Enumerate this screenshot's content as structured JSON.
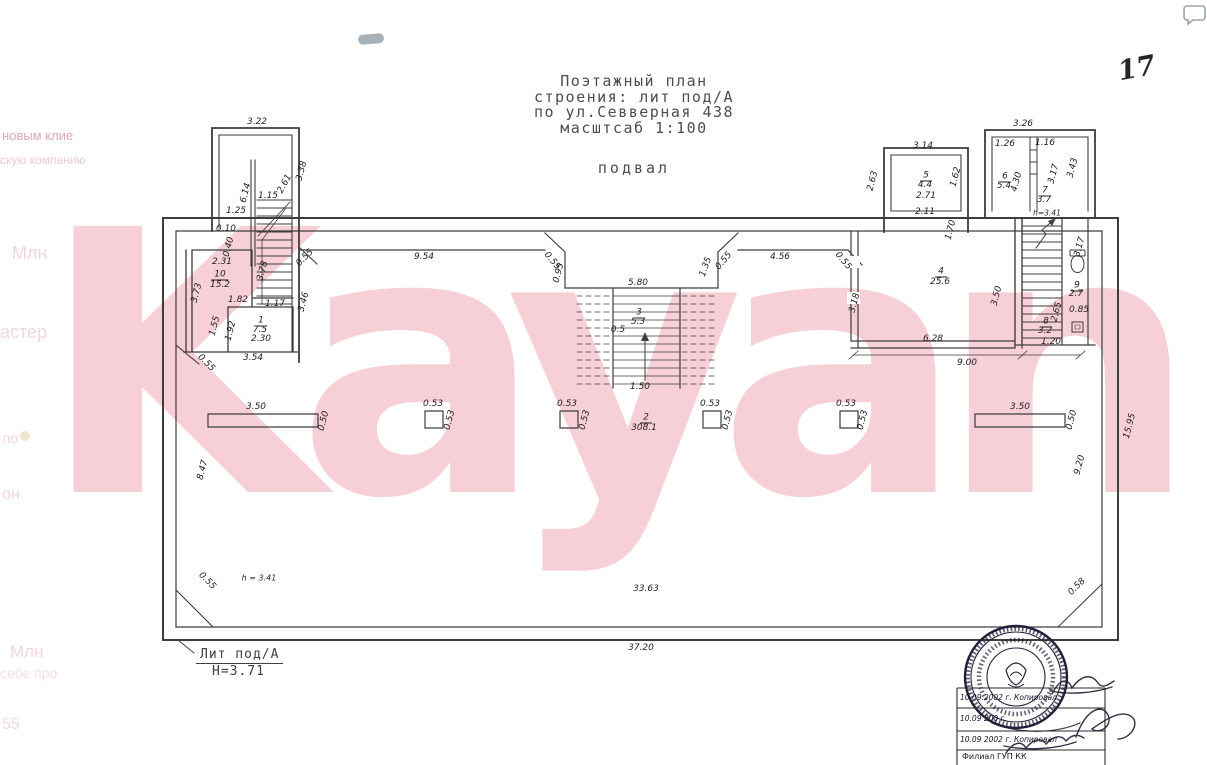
{
  "page": {
    "page_number": "17",
    "watermark_text": "Kayan",
    "watermark_color": "#f7cfd7",
    "line_color": "#3d3d3d",
    "stamp_ink_color": "#20203a"
  },
  "sidebar_fragments": [
    {
      "t": "новым клие",
      "x": 2,
      "y": 128,
      "s": 13,
      "c": "#dfa8b1"
    },
    {
      "t": "скую компанию",
      "x": 0,
      "y": 153,
      "s": 12,
      "c": "#ecc9cf"
    },
    {
      "t": "Млн",
      "x": 12,
      "y": 243,
      "s": 18,
      "c": "#f2d7da"
    },
    {
      "t": "астер",
      "x": 0,
      "y": 322,
      "s": 18,
      "c": "#f2d7da"
    },
    {
      "t": "ло",
      "x": 2,
      "y": 430,
      "s": 14,
      "c": "#f0d4d7"
    },
    {
      "t": "он",
      "x": 2,
      "y": 486,
      "s": 16,
      "c": "#f1d6d9"
    },
    {
      "t": "Млн",
      "x": 10,
      "y": 642,
      "s": 17,
      "c": "#f2d7da"
    },
    {
      "t": "себе про",
      "x": 0,
      "y": 665,
      "s": 14,
      "c": "#f5dfe1"
    },
    {
      "t": "55",
      "x": 2,
      "y": 716,
      "s": 16,
      "c": "#f3dadc"
    }
  ],
  "title_block": {
    "lines": [
      "Поэтажный план",
      "строения: лит под/А",
      "по ул.Севверная 438",
      "масштсаб 1:100"
    ],
    "floor_label": "подвал"
  },
  "plan": {
    "labels": [
      {
        "t": "3.22",
        "x": 257,
        "y": 122
      },
      {
        "t": "3.38",
        "x": 302,
        "y": 171,
        "r": -75
      },
      {
        "t": "6.14",
        "x": 246,
        "y": 193,
        "r": -75
      },
      {
        "t": "1.15",
        "x": 268,
        "y": 196
      },
      {
        "t": "2.61",
        "x": 285,
        "y": 184,
        "r": -62
      },
      {
        "t": "1.25",
        "x": 236,
        "y": 211
      },
      {
        "t": "0.10",
        "x": 226,
        "y": 229
      },
      {
        "t": "0.40",
        "x": 229,
        "y": 247,
        "r": -75
      },
      {
        "t": "2.31",
        "x": 222,
        "y": 262
      },
      {
        "t": "10",
        "x": 220,
        "y": 275,
        "u": 1
      },
      {
        "t": "15.2",
        "x": 220,
        "y": 285
      },
      {
        "t": "3.73",
        "x": 197,
        "y": 293,
        "r": -75
      },
      {
        "t": "1.82",
        "x": 238,
        "y": 300
      },
      {
        "t": "3.78",
        "x": 263,
        "y": 271,
        "r": -75
      },
      {
        "t": "1.17",
        "x": 275,
        "y": 304
      },
      {
        "t": "3.46",
        "x": 304,
        "y": 302,
        "r": -75
      },
      {
        "t": "1.55",
        "x": 215,
        "y": 326,
        "r": -75
      },
      {
        "t": "1",
        "x": 261,
        "y": 321,
        "u": 1
      },
      {
        "t": "7.5",
        "x": 260,
        "y": 330
      },
      {
        "t": "2.30",
        "x": 261,
        "y": 339
      },
      {
        "t": "1.92",
        "x": 231,
        "y": 331,
        "r": -75
      },
      {
        "t": "3.54",
        "x": 253,
        "y": 358
      },
      {
        "t": "0.55",
        "x": 206,
        "y": 363,
        "r": 45
      },
      {
        "t": "0.55",
        "x": 305,
        "y": 258,
        "r": -45
      },
      {
        "t": "9.54",
        "x": 424,
        "y": 257
      },
      {
        "t": "0.55",
        "x": 552,
        "y": 261,
        "r": 50
      },
      {
        "t": "0.95",
        "x": 559,
        "y": 273,
        "r": -75
      },
      {
        "t": "5.80",
        "x": 638,
        "y": 283
      },
      {
        "t": "1.35",
        "x": 706,
        "y": 267,
        "r": -70
      },
      {
        "t": "0.55",
        "x": 724,
        "y": 261,
        "r": -50
      },
      {
        "t": "4.56",
        "x": 780,
        "y": 257
      },
      {
        "t": "0.55",
        "x": 843,
        "y": 261,
        "r": 50
      },
      {
        "t": "2.63",
        "x": 873,
        "y": 181,
        "r": -75
      },
      {
        "t": "3.14",
        "x": 923,
        "y": 146
      },
      {
        "t": "5",
        "x": 926,
        "y": 176,
        "u": 1
      },
      {
        "t": "4.4",
        "x": 925,
        "y": 185
      },
      {
        "t": "1.62",
        "x": 956,
        "y": 177,
        "r": -75
      },
      {
        "t": "2.71",
        "x": 926,
        "y": 196
      },
      {
        "t": "2.11",
        "x": 925,
        "y": 212
      },
      {
        "t": "1.70",
        "x": 951,
        "y": 230,
        "r": -75
      },
      {
        "t": "3.18",
        "x": 855,
        "y": 303,
        "r": -75
      },
      {
        "t": "4",
        "x": 941,
        "y": 272,
        "u": 1
      },
      {
        "t": "25.6",
        "x": 940,
        "y": 282
      },
      {
        "t": "3.50",
        "x": 997,
        "y": 296,
        "r": -75
      },
      {
        "t": "6.28",
        "x": 933,
        "y": 339
      },
      {
        "t": "9.00",
        "x": 967,
        "y": 363
      },
      {
        "t": "3.26",
        "x": 1023,
        "y": 124
      },
      {
        "t": "1.26",
        "x": 1005,
        "y": 144
      },
      {
        "t": "1.16",
        "x": 1045,
        "y": 143
      },
      {
        "t": "6",
        "x": 1005,
        "y": 177,
        "u": 1
      },
      {
        "t": "5.4",
        "x": 1004,
        "y": 186
      },
      {
        "t": "4.30",
        "x": 1017,
        "y": 182,
        "r": -75
      },
      {
        "t": "7",
        "x": 1045,
        "y": 191,
        "u": 1
      },
      {
        "t": "3.7",
        "x": 1044,
        "y": 200
      },
      {
        "t": "3.17",
        "x": 1054,
        "y": 174,
        "r": -75
      },
      {
        "t": "3.43",
        "x": 1073,
        "y": 168,
        "r": -75
      },
      {
        "t": "h=3.41",
        "x": 1047,
        "y": 213,
        "s": 7.5
      },
      {
        "t": "3.17",
        "x": 1080,
        "y": 247,
        "r": -75
      },
      {
        "t": "9",
        "x": 1077,
        "y": 286,
        "u": 1
      },
      {
        "t": "2.7",
        "x": 1076,
        "y": 294
      },
      {
        "t": "0.85",
        "x": 1079,
        "y": 310
      },
      {
        "t": "2.65",
        "x": 1057,
        "y": 312,
        "r": -75
      },
      {
        "t": "8",
        "x": 1046,
        "y": 322,
        "u": 1
      },
      {
        "t": "3.2",
        "x": 1045,
        "y": 331
      },
      {
        "t": "1.20",
        "x": 1051,
        "y": 342
      },
      {
        "t": "3",
        "x": 639,
        "y": 313,
        "u": 1
      },
      {
        "t": "5.3",
        "x": 638,
        "y": 322
      },
      {
        "t": "0.5",
        "x": 618,
        "y": 330
      },
      {
        "t": "1.50",
        "x": 640,
        "y": 387
      },
      {
        "t": "3.50",
        "x": 256,
        "y": 407
      },
      {
        "t": "0.50",
        "x": 324,
        "y": 421,
        "r": -75
      },
      {
        "t": "0.53",
        "x": 433,
        "y": 404
      },
      {
        "t": "0.53",
        "x": 450,
        "y": 420,
        "r": -75
      },
      {
        "t": "0.53",
        "x": 567,
        "y": 404
      },
      {
        "t": "0.53",
        "x": 585,
        "y": 420,
        "r": -75
      },
      {
        "t": "2",
        "x": 646,
        "y": 418,
        "u": 1
      },
      {
        "t": "308.1",
        "x": 644,
        "y": 428
      },
      {
        "t": "0.53",
        "x": 710,
        "y": 404
      },
      {
        "t": "0.53",
        "x": 728,
        "y": 420,
        "r": -75
      },
      {
        "t": "0.53",
        "x": 846,
        "y": 404
      },
      {
        "t": "0.53",
        "x": 863,
        "y": 420,
        "r": -75
      },
      {
        "t": "3.50",
        "x": 1020,
        "y": 407
      },
      {
        "t": "0.50",
        "x": 1072,
        "y": 420,
        "r": -75
      },
      {
        "t": "8.47",
        "x": 203,
        "y": 470,
        "r": -75
      },
      {
        "t": "0.55",
        "x": 207,
        "y": 581,
        "r": 45
      },
      {
        "t": "h = 3.41",
        "x": 259,
        "y": 578,
        "s": 8
      },
      {
        "t": "33.63",
        "x": 646,
        "y": 589
      },
      {
        "t": "0.58",
        "x": 1077,
        "y": 587,
        "r": -45
      },
      {
        "t": "9.20",
        "x": 1080,
        "y": 465,
        "r": -75
      },
      {
        "t": "15.95",
        "x": 1130,
        "y": 426,
        "r": -75
      },
      {
        "t": "37.20",
        "x": 641,
        "y": 648
      }
    ]
  },
  "footer": {
    "lit_label": "Лит под/А",
    "height_label": "Н=3.71"
  },
  "stamp": {
    "rows": [
      "10.09.2002 г.  Копировал",
      "10.09 200  г.",
      "10.09 2002 г.  Копировал",
      "Филиал ГУП КК"
    ]
  }
}
